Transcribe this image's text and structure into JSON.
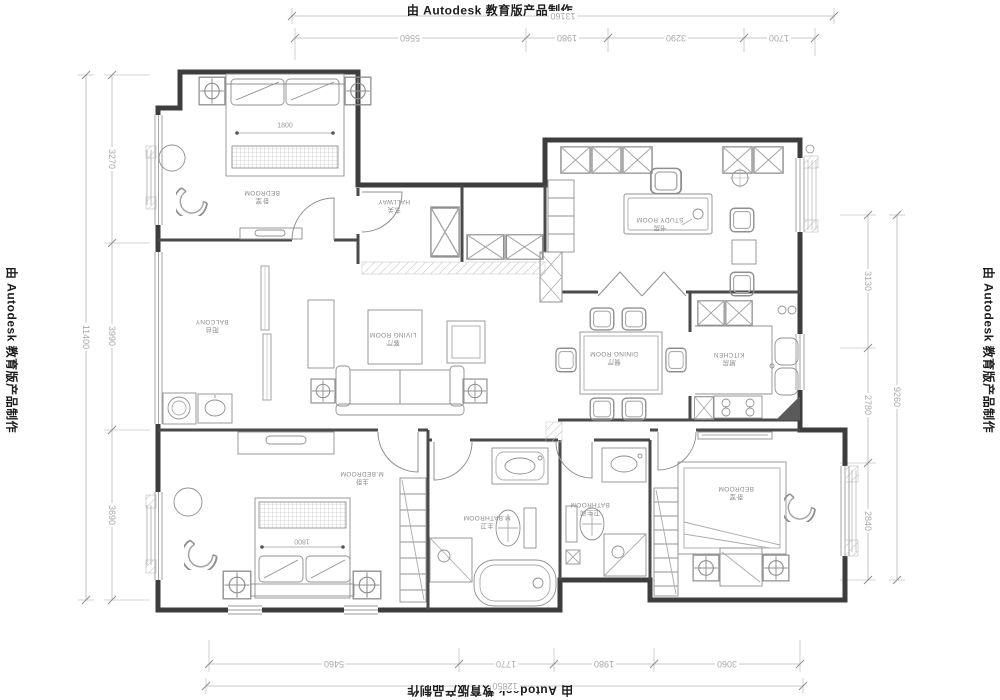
{
  "watermark": {
    "text": "由 Autodesk 教育版产品制作"
  },
  "dimensions": {
    "top": {
      "total": "13160",
      "segments": [
        "5560",
        "1980",
        "3290",
        "1700"
      ]
    },
    "bottom": {
      "total": "12850",
      "segments": [
        "5460",
        "1770",
        "1980",
        "3060"
      ]
    },
    "left": {
      "total": "11400",
      "segments": [
        "3270",
        "3990",
        "3690"
      ]
    },
    "right": {
      "total": "9260",
      "segments": [
        "3130",
        "2780",
        "2840"
      ]
    }
  },
  "rooms": [
    {
      "id": "bedroom-1",
      "zh": "卧室",
      "en": "BEDROOM"
    },
    {
      "id": "hallway",
      "zh": "玄关",
      "en": "HALLWAY"
    },
    {
      "id": "study",
      "zh": "书房",
      "en": "STUDY ROOM"
    },
    {
      "id": "balcony",
      "zh": "阳台",
      "en": "BALCONY"
    },
    {
      "id": "living-room",
      "zh": "客厅",
      "en": "LIVING ROOM"
    },
    {
      "id": "dining-room",
      "zh": "餐厅",
      "en": "DINING ROOM"
    },
    {
      "id": "kitchen",
      "zh": "厨房",
      "en": "KITCHEN"
    },
    {
      "id": "master-bedroom",
      "zh": "主卧",
      "en": "M.BEDROOM"
    },
    {
      "id": "master-bathroom",
      "zh": "主卫",
      "en": "M.BATHROOM"
    },
    {
      "id": "bathroom",
      "zh": "卫生间",
      "en": "BATHROOM"
    },
    {
      "id": "bedroom-2",
      "zh": "卧室",
      "en": "BEDROOM"
    }
  ],
  "furniture": {
    "bed1_width": "1800",
    "bed2_width": "1800"
  }
}
